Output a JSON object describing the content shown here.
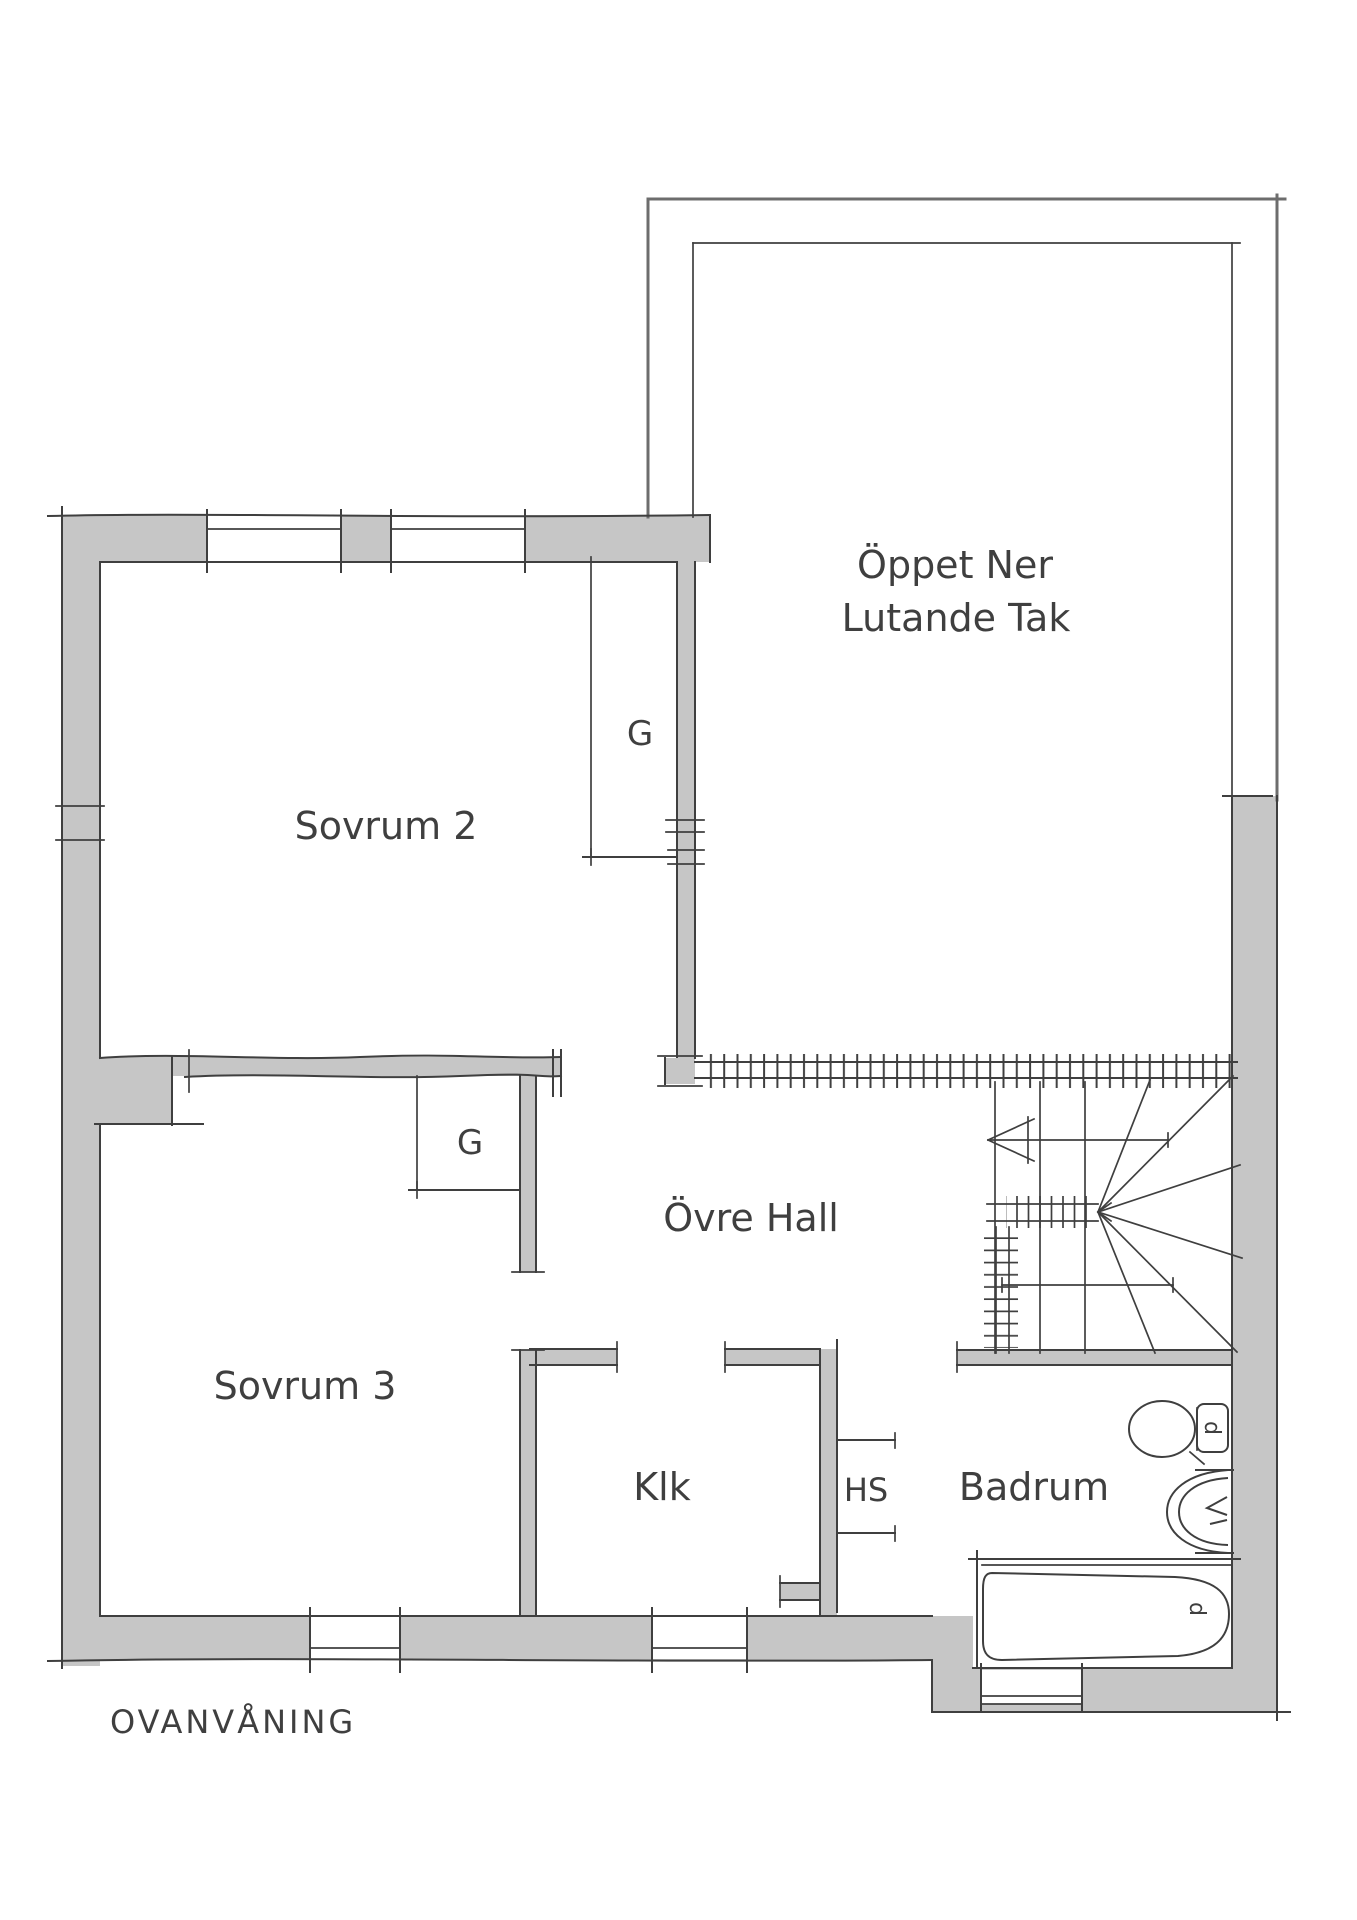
{
  "page_title": "OVANVÅNING",
  "plan": {
    "rooms": [
      {
        "id": "sovrum2",
        "label": "Sovrum 2"
      },
      {
        "id": "sovrum3",
        "label": "Sovrum 3"
      },
      {
        "id": "ovre_hall",
        "label": "Övre Hall"
      },
      {
        "id": "klk",
        "label": "Klk"
      },
      {
        "id": "hs",
        "label": "HS"
      },
      {
        "id": "badrum",
        "label": "Badrum"
      }
    ],
    "open_area": {
      "line1": "Öppet Ner",
      "line2": "Lutande Tak"
    },
    "wardrobes": [
      {
        "id": "g_sovrum2",
        "label": "G"
      },
      {
        "id": "g_sovrum3",
        "label": "G"
      }
    ],
    "drains": [
      {
        "id": "toilet_drain",
        "label": "d"
      },
      {
        "id": "bathtub_drain",
        "label": "d"
      }
    ]
  },
  "colors": {
    "wall_fill": "#c6c6c6",
    "line_dark": "#3f3f3f",
    "line_medium": "#6d6d6d",
    "background": "#ffffff"
  }
}
